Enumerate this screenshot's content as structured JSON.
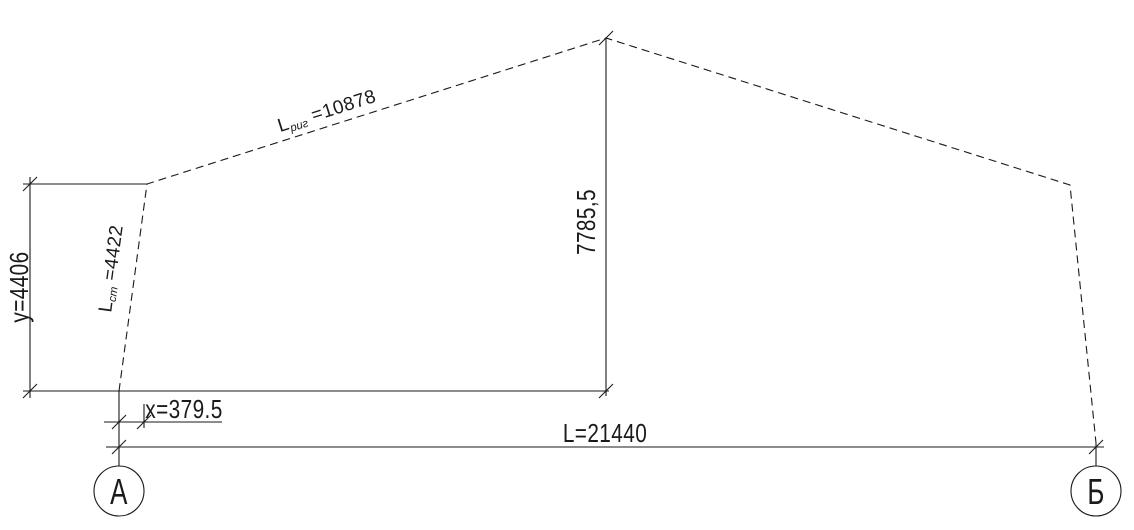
{
  "drawing": {
    "description": "frame-geometry-scheme",
    "dimensions": {
      "span": "L=21440",
      "total_height": "7785,5",
      "eave_height": "y=4406",
      "column_offset": "x=379.5",
      "rafter": {
        "prefix": "L",
        "sub": "риг",
        "rest": " =10878"
      },
      "column": {
        "prefix": "L",
        "sub": "ст",
        "rest": " =4422"
      }
    },
    "axis_markers": [
      {
        "label": "А"
      },
      {
        "label": "Б"
      }
    ],
    "colors": {
      "line": "#1a1a1a",
      "background": "#ffffff"
    }
  }
}
